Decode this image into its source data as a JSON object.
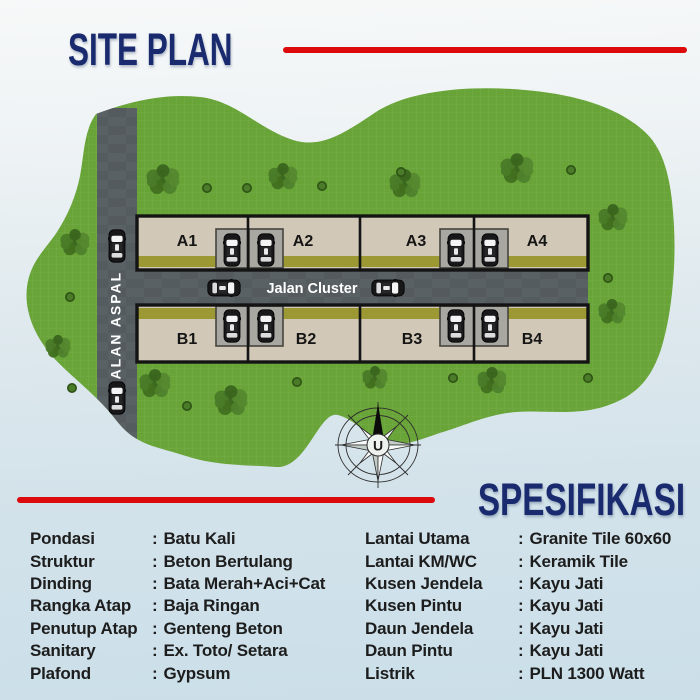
{
  "header": {
    "title": "SITE PLAN",
    "accent_color": "#dc0a0a",
    "title_color": "#1a2a6e"
  },
  "siteplan": {
    "road_vertical_label": "JALAN ASPAL",
    "road_horizontal_label": "Jalan Cluster",
    "compass_label": "U",
    "units_a": [
      "A1",
      "A2",
      "A3",
      "A4"
    ],
    "units_b": [
      "B1",
      "B2",
      "B3",
      "B4"
    ],
    "colors": {
      "grass": "#68a437",
      "road": "#5a6165",
      "plot": "#d2c8b7",
      "garden_strip": "#9c9833",
      "driveway": "#a8a7a1"
    },
    "trees": [
      {
        "x": 163,
        "y": 180,
        "r": 17
      },
      {
        "x": 283,
        "y": 177,
        "r": 15
      },
      {
        "x": 405,
        "y": 184,
        "r": 16
      },
      {
        "x": 517,
        "y": 169,
        "r": 17
      },
      {
        "x": 613,
        "y": 218,
        "r": 15
      },
      {
        "x": 612,
        "y": 312,
        "r": 14
      },
      {
        "x": 75,
        "y": 243,
        "r": 15
      },
      {
        "x": 58,
        "y": 347,
        "r": 13
      },
      {
        "x": 155,
        "y": 384,
        "r": 16
      },
      {
        "x": 231,
        "y": 401,
        "r": 17
      },
      {
        "x": 375,
        "y": 378,
        "r": 13
      },
      {
        "x": 492,
        "y": 381,
        "r": 15
      }
    ],
    "bushes": [
      {
        "x": 207,
        "y": 188
      },
      {
        "x": 247,
        "y": 188
      },
      {
        "x": 322,
        "y": 186
      },
      {
        "x": 401,
        "y": 172
      },
      {
        "x": 571,
        "y": 170
      },
      {
        "x": 608,
        "y": 278
      },
      {
        "x": 70,
        "y": 297
      },
      {
        "x": 72,
        "y": 388
      },
      {
        "x": 187,
        "y": 406
      },
      {
        "x": 297,
        "y": 382
      },
      {
        "x": 453,
        "y": 378
      },
      {
        "x": 588,
        "y": 378
      }
    ],
    "cars": [
      {
        "x": 117,
        "y": 246,
        "rot": 0
      },
      {
        "x": 117,
        "y": 398,
        "rot": 0
      },
      {
        "x": 232,
        "y": 250,
        "rot": 0
      },
      {
        "x": 266,
        "y": 250,
        "rot": 0
      },
      {
        "x": 456,
        "y": 250,
        "rot": 0
      },
      {
        "x": 490,
        "y": 250,
        "rot": 0
      },
      {
        "x": 232,
        "y": 326,
        "rot": 0
      },
      {
        "x": 266,
        "y": 326,
        "rot": 0
      },
      {
        "x": 456,
        "y": 326,
        "rot": 0
      },
      {
        "x": 490,
        "y": 326,
        "rot": 0
      },
      {
        "x": 224,
        "y": 288,
        "rot": 90
      },
      {
        "x": 388,
        "y": 288,
        "rot": 90
      }
    ]
  },
  "spec": {
    "title": "SPESIFIKASI",
    "colon": ":",
    "left": [
      {
        "label": "Pondasi",
        "value": "Batu Kali"
      },
      {
        "label": "Struktur",
        "value": "Beton Bertulang"
      },
      {
        "label": "Dinding",
        "value": "Bata Merah+Aci+Cat"
      },
      {
        "label": "Rangka Atap",
        "value": "Baja Ringan"
      },
      {
        "label": "Penutup Atap",
        "value": "Genteng Beton"
      },
      {
        "label": "Sanitary",
        "value": "Ex. Toto/ Setara"
      },
      {
        "label": "Plafond",
        "value": "Gypsum"
      }
    ],
    "right": [
      {
        "label": "Lantai Utama",
        "value": "Granite Tile 60x60"
      },
      {
        "label": "Lantai KM/WC",
        "value": "Keramik Tile"
      },
      {
        "label": "Kusen Jendela",
        "value": "Kayu Jati"
      },
      {
        "label": "Kusen Pintu",
        "value": "Kayu Jati"
      },
      {
        "label": "Daun Jendela",
        "value": "Kayu Jati"
      },
      {
        "label": "Daun Pintu",
        "value": "Kayu Jati"
      },
      {
        "label": "Listrik",
        "value": "PLN 1300 Watt"
      }
    ]
  }
}
